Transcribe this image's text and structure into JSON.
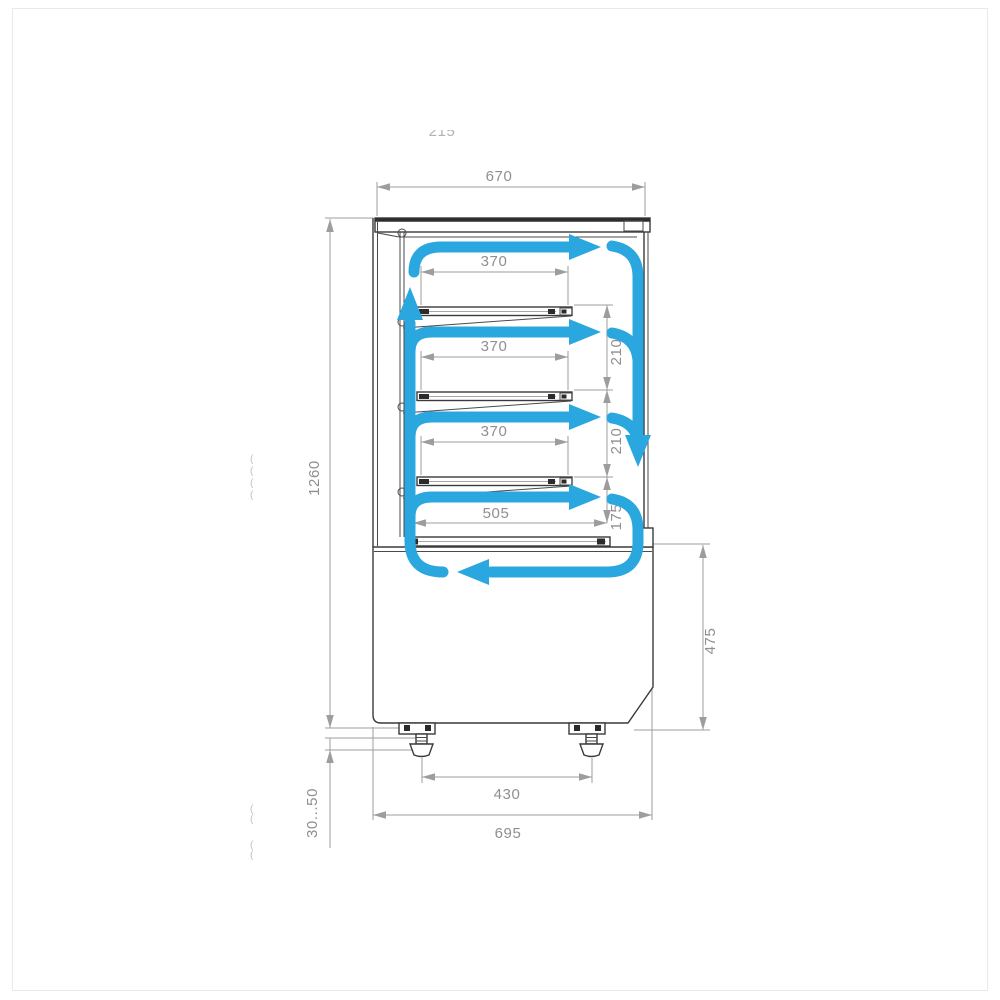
{
  "figure": {
    "description": "Technical side-view dimension diagram of a refrigerated display case with blue air-circulation arrows",
    "colors": {
      "airflow": "#2ba7df",
      "outline": "#3a3a3a",
      "dimension": "#9d9d9d"
    }
  },
  "dimensions": {
    "canopy_width": "670",
    "shelf_depth": "370",
    "shelf_gap_upper": "210",
    "shelf_gap_lower": "210",
    "deck_clearance": "175",
    "deck_depth": "505",
    "overall_height": "1260",
    "leveling_range": "30...50",
    "base_height": "475",
    "feet_spacing": "430",
    "base_depth": "695"
  },
  "faded_marks": {
    "top_partial": "215",
    "fragment_glyph": "("
  }
}
